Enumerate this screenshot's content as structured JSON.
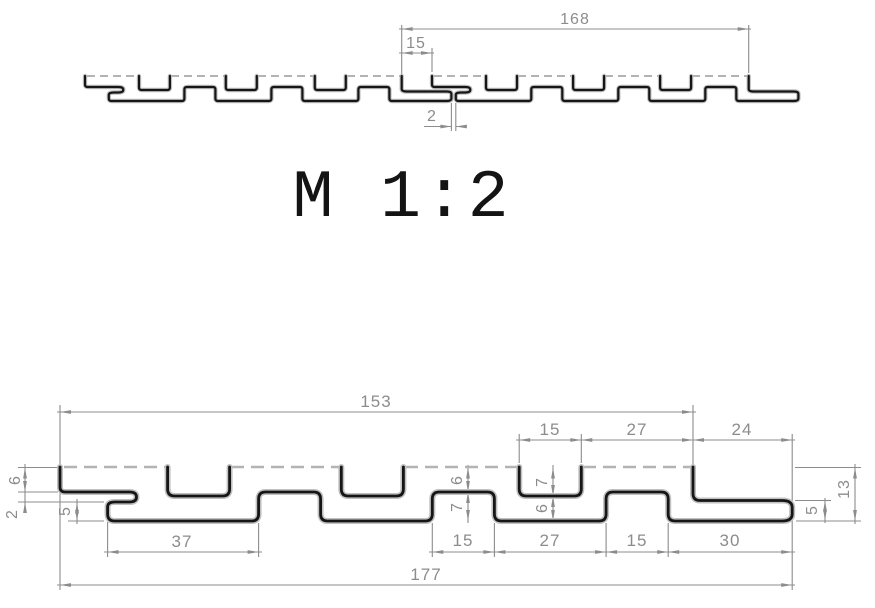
{
  "scale_label": "M 1:2",
  "top_view": {
    "title": "assembled-panels-section",
    "dims": {
      "panel_pitch": "168",
      "seam_groove_width": "15",
      "seam_gap": "2"
    }
  },
  "bottom_view": {
    "title": "single-panel-section",
    "dims_top": {
      "face_width": "153",
      "groove_width": "15",
      "slat_width": "27",
      "end_tab_length": "24"
    },
    "dims_left": {
      "face_to_tongue": "6",
      "tongue_thickness": "2",
      "tongue_to_bottom": "5"
    },
    "dims_channel": {
      "cover_depth": "6",
      "channel_height": "7"
    },
    "dims_groove": {
      "groove_depth": "7",
      "web_below": "6"
    },
    "dims_bottom": {
      "hook_to_channel": "37",
      "channel_a": "15",
      "web_between": "27",
      "channel_b": "15",
      "end_run": "30",
      "overall_width": "177"
    },
    "dims_right": {
      "overall_height": "13",
      "tab_thickness": "5"
    }
  },
  "colors": {
    "profile_line": "#161616",
    "dimension_gray": "#8c8c8c",
    "hidden_dash": "#b3b3b3",
    "background": "#ffffff"
  }
}
